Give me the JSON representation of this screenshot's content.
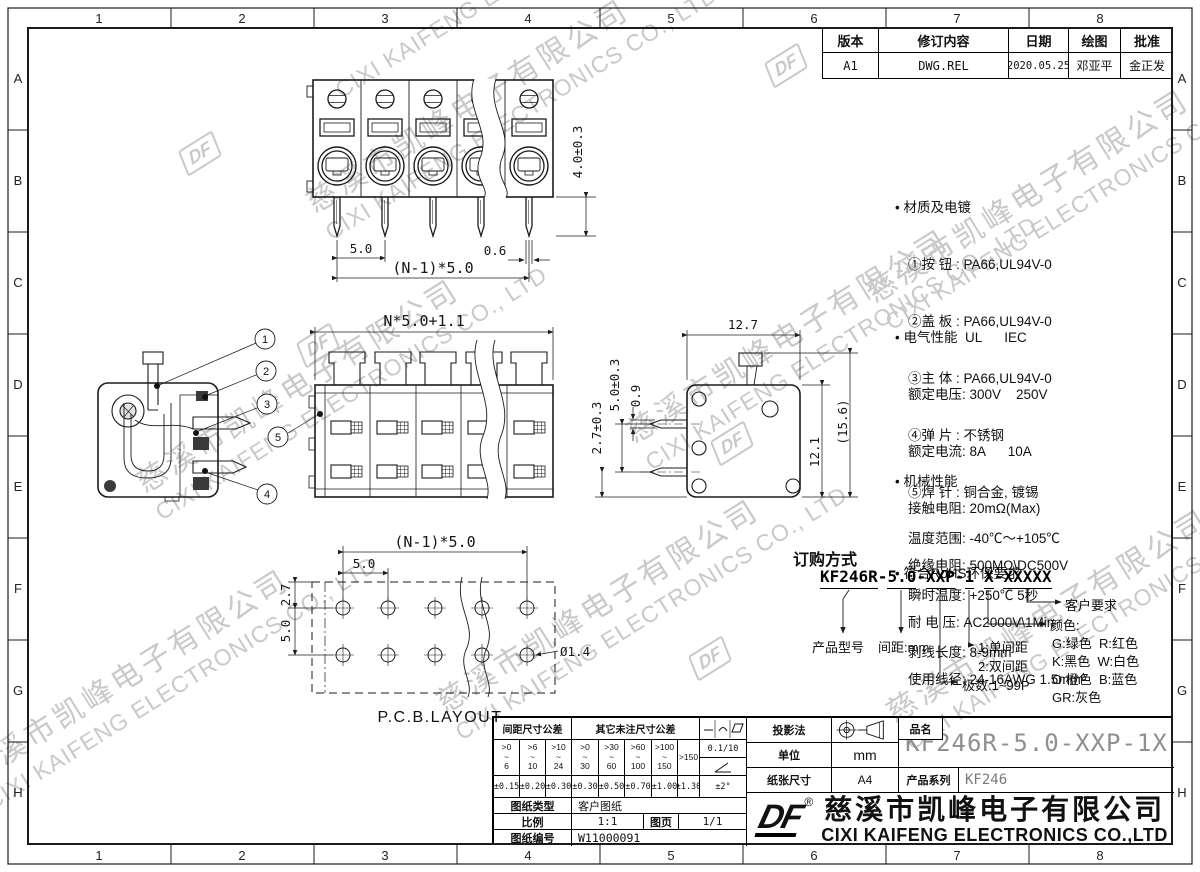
{
  "zones": {
    "cols": [
      "1",
      "2",
      "3",
      "4",
      "5",
      "6",
      "7",
      "8"
    ],
    "rows": [
      "A",
      "B",
      "C",
      "D",
      "E",
      "F",
      "G",
      "H"
    ]
  },
  "watermark": {
    "cn": "慈溪市凯峰电子有限公司",
    "en": "CIXI KAIFENG ELECTRONICS CO., LTD",
    "logo": "DF"
  },
  "revision": {
    "headers": [
      "版本",
      "修订内容",
      "日期",
      "绘图",
      "批准"
    ],
    "row": [
      "A1",
      "DWG.REL",
      "2020.05.25",
      "邓亚平",
      "金正发"
    ]
  },
  "notes": {
    "material": {
      "title": "• 材质及电镀",
      "lines": [
        "①按 钮 : PA66,UL94V-0",
        "②盖 板 : PA66,UL94V-0",
        "③主 体 : PA66,UL94V-0",
        "④弹 片 : 不锈钢",
        "⑤焊 针 : 铜合金, 镀锡"
      ]
    },
    "electrical": {
      "title": "• 电气性能  UL      IEC",
      "lines": [
        "额定电压: 300V    250V",
        "额定电流: 8A      10A",
        "接触电阻: 20mΩ(Max)",
        "绝缘电阻: 500MΩ\\DC500V",
        "耐 电 压: AC2000V\\1Min",
        "使用线径: 24-16AWG 1.5mm²"
      ]
    },
    "mechanical": {
      "title": "• 机械性能",
      "lines": [
        "温度范围: -40℃～+105℃",
        "瞬时温度: +250℃ 5秒",
        "剥线长度: 8-9mm"
      ]
    },
    "rohs": "• 符合RoHS环保要求"
  },
  "ordering": {
    "heading": "订购方式",
    "code": {
      "s0": "KF246R",
      "s1": "-",
      "s2": "5.0",
      "s3": "-",
      "s4": "XXP",
      "s5": "-",
      "s6": "1",
      "s7": " ",
      "s8": "X",
      "s9": "-",
      "s10": "XXXXX"
    },
    "labels": {
      "product": "产品型号",
      "pitch": "间距:mm",
      "single": "1:单间距",
      "double": "2:双间距",
      "poles": "极数:1~99P",
      "color_header": "颜色:",
      "colors": [
        "G:绿色  R:红色",
        "K:黑色  W:白色",
        "O:橙色  B:蓝色",
        "GR:灰色"
      ],
      "customer": "客户要求"
    }
  },
  "views": {
    "top": {
      "pin_len": "4.0±0.3",
      "pitch": "5.0",
      "pin_w": "0.6",
      "span": "(N-1)*5.0"
    },
    "front": {
      "width": "N*5.0+1.1"
    },
    "side": {
      "depth": "12.7",
      "pin_pitch": "5.0±0.3",
      "pin_t": "0.9",
      "pin_off": "2.7±0.3",
      "height": "12.1",
      "total_h": "(15.6)"
    },
    "pcb": {
      "span": "(N-1)*5.0",
      "pitch": "5.0",
      "row": "5.0",
      "edge": "2.7",
      "hole": "Ø1.4",
      "label": "P.C.B.LAYOUT"
    },
    "callouts": [
      "1",
      "2",
      "3",
      "4",
      "5"
    ]
  },
  "title_block": {
    "tol": {
      "h_pitch": "间距尺寸公差",
      "h_other": "其它未注尺寸公差",
      "ranges": [
        ">0\n~\n6",
        ">6\n~\n10",
        ">10\n~\n24",
        ">0\n~\n30",
        ">30\n~\n60",
        ">60\n~\n100",
        ">100\n~\n150"
      ],
      "range_last": ">150",
      "vals": [
        "±0.15",
        "±0.20",
        "±0.30",
        "±0.30",
        "±0.50",
        "±0.70",
        "±1.00",
        "±1.30"
      ],
      "sym_flat": "0.1/10",
      "sym_ang_val": "±2°",
      "symbols": [
        "straightness",
        "arc",
        "parallelogram",
        "angularity"
      ]
    },
    "info": {
      "type_label": "图纸类型",
      "type_value": "客户图纸",
      "scale_label": "比例",
      "scale_value": "1:1",
      "page_label": "图页",
      "page_value": "1/1",
      "no_label": "图纸编号",
      "no_value": "W11000091"
    },
    "proj_label": "投影法",
    "unit_label": "单位",
    "unit_value": "mm",
    "paper_label": "纸张尺寸",
    "paper_value": "A4",
    "part_label": "品名",
    "part_value": "KF246R-5.0-XXP-1X",
    "series_label": "产品系列",
    "series_value": "KF246",
    "company": {
      "logo": "DF",
      "reg": "®",
      "cn": "慈溪市凯峰电子有限公司",
      "en": "CIXI KAIFENG ELECTRONICS CO.,LTD"
    }
  }
}
